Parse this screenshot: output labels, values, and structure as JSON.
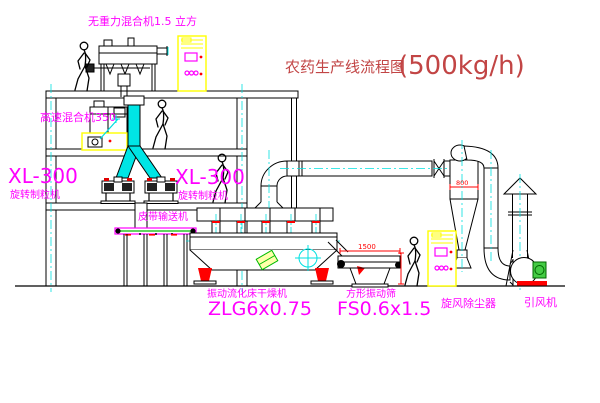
{
  "title": {
    "text": "农药生产线流程图",
    "capacity": "(500kg/h)"
  },
  "colors": {
    "background": "#ffffff",
    "drawing_line": "#000000",
    "centerline_cyan": "#00e0e0",
    "cabinet_yellow": "#ffff00",
    "label_magenta": "#ff00ff",
    "dimension_red": "#ff0000",
    "title_red": "#c24545",
    "conveyor_green": "#00bb00"
  },
  "equipment": {
    "gravity_mixer": {
      "label": "无重力混合机1.5 立方"
    },
    "high_speed_mixer": {
      "label": "高速混合机350"
    },
    "granulator_left": {
      "model": "XL-300",
      "name": "旋转制粒机"
    },
    "granulator_right": {
      "model": "XL-300",
      "name": "旋转制粒机"
    },
    "belt_conveyor": {
      "label": "皮带输送机"
    },
    "fluid_bed_dryer": {
      "name": "振动流化床干燥机",
      "model": "ZLG6x0.75"
    },
    "vibrating_screen": {
      "name": "方形振动筛",
      "model": "FS0.6x1.5",
      "dim_width": "1500"
    },
    "cyclone": {
      "name": "旋风除尘器",
      "dim_diameter": "800"
    },
    "fan": {
      "name": "引风机"
    }
  }
}
